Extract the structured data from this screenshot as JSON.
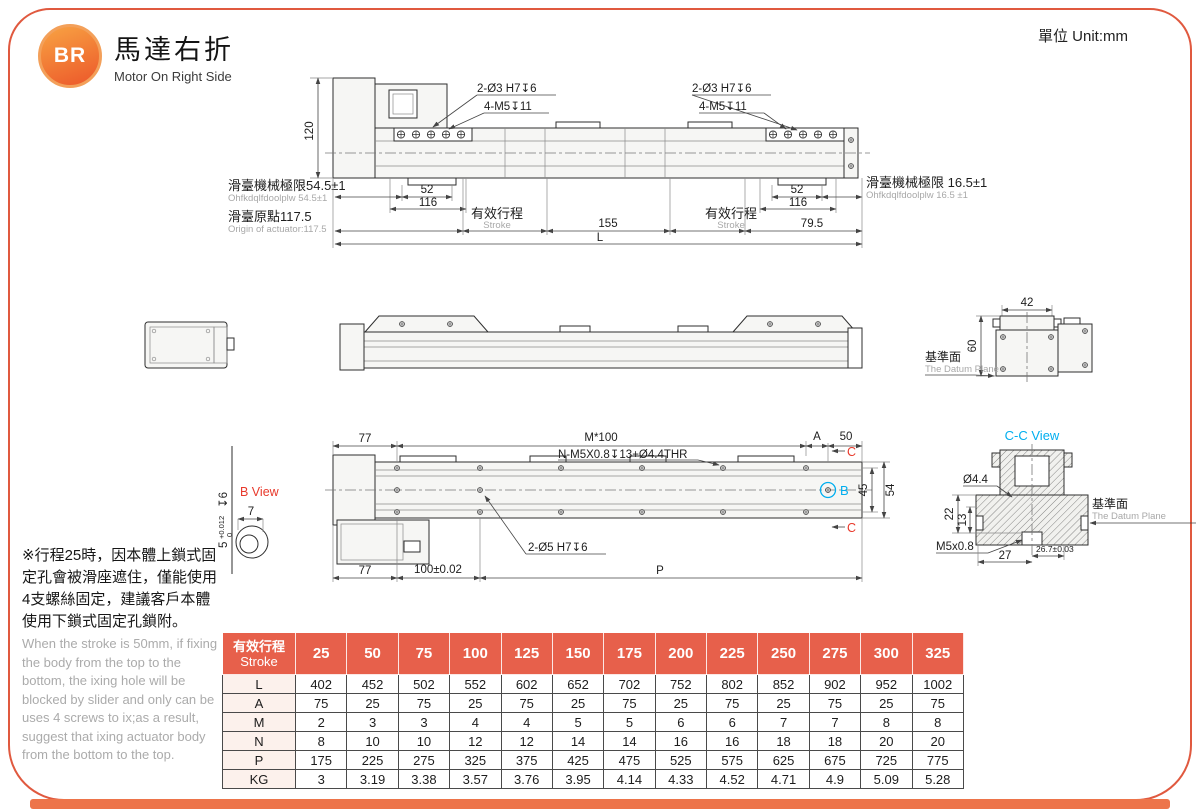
{
  "header": {
    "logo_text": "BR",
    "title_zh": "馬達右折",
    "title_en": "Motor On Right Side",
    "unit_label": "單位 Unit:mm"
  },
  "colors": {
    "accent": "#e7604b",
    "frame_border": "#e0593f",
    "red_label": "#e8392b",
    "cyan_label": "#00aeef",
    "gray_text": "#a8a8a8"
  },
  "top_view": {
    "dim_120": "120",
    "label_holes_a_left": "2-Ø3 H7↧6",
    "label_holes_b_left": "4-M5↧11",
    "label_holes_a_right": "2-Ø3 H7↧6",
    "label_holes_b_right": "4-M5↧11",
    "mech_limit_left_zh": "滑臺機械極限54.5±1",
    "mech_limit_left_en": "Ohfkdqlfdoolplw 54.5±1",
    "origin_zh": "滑臺原點117.5",
    "origin_en": "Origin of actuator:117.5",
    "mech_limit_right_zh": "滑臺機械極限 16.5±1",
    "mech_limit_right_en": "Ohfkdqlfdoolplw 16.5 ±1",
    "dim_52_left": "52",
    "dim_116_left": "116",
    "dim_52_right": "52",
    "dim_116_right": "116",
    "stroke_zh_left": "有效行程",
    "stroke_en_left": "Stroke",
    "dim_155": "155",
    "stroke_zh_right": "有效行程",
    "stroke_en_right": "Stroke",
    "dim_79_5": "79.5",
    "dim_L": "L"
  },
  "side_view": {
    "dim_42": "42",
    "dim_60": "60",
    "datum_zh": "基準面",
    "datum_en": "The Datum Plane"
  },
  "bottom_view": {
    "dim_77_top": "77",
    "dim_M100": "M*100",
    "thread_note": "N-M5X0.8↧13+Ø4.4THR",
    "dim_A": "A",
    "dim_50": "50",
    "section_c": "C",
    "section_b": "B",
    "dim_45": "45",
    "dim_54": "54",
    "label_holes": "2-Ø5 H7↧6",
    "dim_77_bottom": "77",
    "dim_100": "100±0.02",
    "dim_P": "P"
  },
  "b_view": {
    "title": "B View",
    "dim_7": "7",
    "dim_5": "5",
    "tol_upper": "+0.012",
    "tol_lower": "0",
    "depth": "↧6"
  },
  "cc_view": {
    "title": "C-C View",
    "dim_4_4": "Ø4.4",
    "dim_22": "22",
    "dim_13": "13",
    "thread": "M5x0.8",
    "dim_27": "27",
    "dim_26_7": "26.7±0.03",
    "datum_zh": "基準面",
    "datum_en": "The Datum Plane"
  },
  "notes": {
    "zh": "※行程25時，因本體上鎖式固定孔會被滑座遮住，僅能使用4支螺絲固定，建議客戶本體使用下鎖式固定孔鎖附。",
    "en": "When the stroke is 50mm, if fixing the body from the top to the bottom, the ixing hole will be blocked by slider and only can be uses 4 screws to ix;as a result, suggest that ixing actuator body from the bottom to the top."
  },
  "table": {
    "header_zh": "有效行程",
    "header_en": "Stroke",
    "strokes": [
      "25",
      "50",
      "75",
      "100",
      "125",
      "150",
      "175",
      "200",
      "225",
      "250",
      "275",
      "300",
      "325"
    ],
    "rows": [
      {
        "label": "L",
        "values": [
          "402",
          "452",
          "502",
          "552",
          "602",
          "652",
          "702",
          "752",
          "802",
          "852",
          "902",
          "952",
          "1002"
        ]
      },
      {
        "label": "A",
        "values": [
          "75",
          "25",
          "75",
          "25",
          "75",
          "25",
          "75",
          "25",
          "75",
          "25",
          "75",
          "25",
          "75"
        ]
      },
      {
        "label": "M",
        "values": [
          "2",
          "3",
          "3",
          "4",
          "4",
          "5",
          "5",
          "6",
          "6",
          "7",
          "7",
          "8",
          "8"
        ]
      },
      {
        "label": "N",
        "values": [
          "8",
          "10",
          "10",
          "12",
          "12",
          "14",
          "14",
          "16",
          "16",
          "18",
          "18",
          "20",
          "20"
        ]
      },
      {
        "label": "P",
        "values": [
          "175",
          "225",
          "275",
          "325",
          "375",
          "425",
          "475",
          "525",
          "575",
          "625",
          "675",
          "725",
          "775"
        ]
      },
      {
        "label": "KG",
        "values": [
          "3",
          "3.19",
          "3.38",
          "3.57",
          "3.76",
          "3.95",
          "4.14",
          "4.33",
          "4.52",
          "4.71",
          "4.9",
          "5.09",
          "5.28"
        ]
      }
    ]
  }
}
